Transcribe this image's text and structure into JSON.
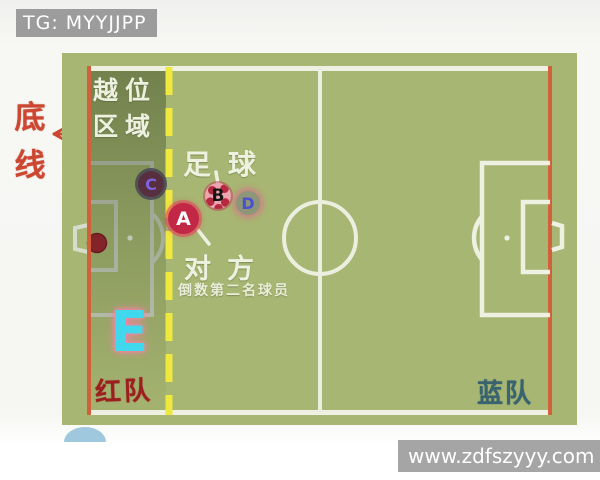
{
  "banner": {
    "tag_text": "TG: MYYJJPP"
  },
  "watermark": {
    "url_text": "www.zdfszyyy.com"
  },
  "diagram": {
    "endline_label": "底线",
    "offside_area_line1": "越位",
    "offside_area_line2": "区域",
    "football_label": "足球",
    "opponent_label": "对方",
    "opponent_sub_label": "倒数第二名球员",
    "red_team_label": "红队",
    "blue_team_label": "蓝队"
  },
  "players": {
    "A": {
      "label": "A",
      "color": "#c22845"
    },
    "B": {
      "label": "B",
      "color": "#eba6b2"
    },
    "C": {
      "label": "C",
      "color": "#572f3f"
    },
    "D": {
      "label": "D",
      "color": "#8d9679"
    },
    "E": {
      "label": "E",
      "color": "#3fd8ec"
    }
  },
  "colors": {
    "field_green": "#a7b672",
    "goal_line_red": "#d2603c",
    "offside_line_yellow": "#efe93f",
    "chalk_white": "#edf0e0",
    "red_team_text": "#9b1f1f",
    "blue_team_text": "#39636e",
    "endline_text": "#cc4731"
  }
}
